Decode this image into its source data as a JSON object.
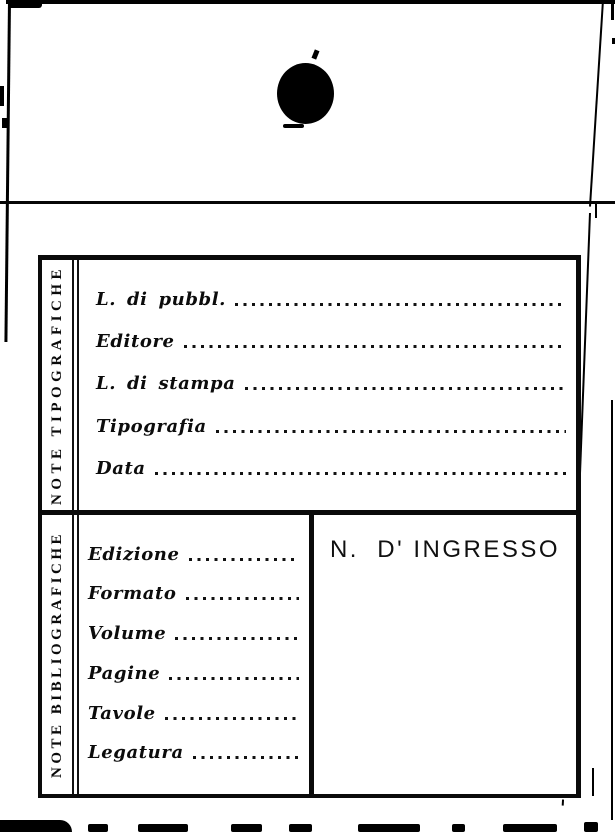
{
  "colors": {
    "ink": "#0a0a0a",
    "paper": "#ffffff"
  },
  "sections": [
    {
      "side_label": "NOTE TIPOGRAFICHE",
      "fields": [
        {
          "label": "L. di pubbl."
        },
        {
          "label": "Editore"
        },
        {
          "label": "L. di stampa"
        },
        {
          "label": "Tipografia"
        },
        {
          "label": "Data"
        }
      ]
    },
    {
      "side_label": "NOTE BIBLIOGRAFICHE",
      "ingresso_header": "N.  D' INGRESSO",
      "fields": [
        {
          "label": "Edizione"
        },
        {
          "label": "Formato"
        },
        {
          "label": "Volume"
        },
        {
          "label": "Pagine"
        },
        {
          "label": "Tavole"
        },
        {
          "label": "Legatura"
        }
      ]
    }
  ]
}
